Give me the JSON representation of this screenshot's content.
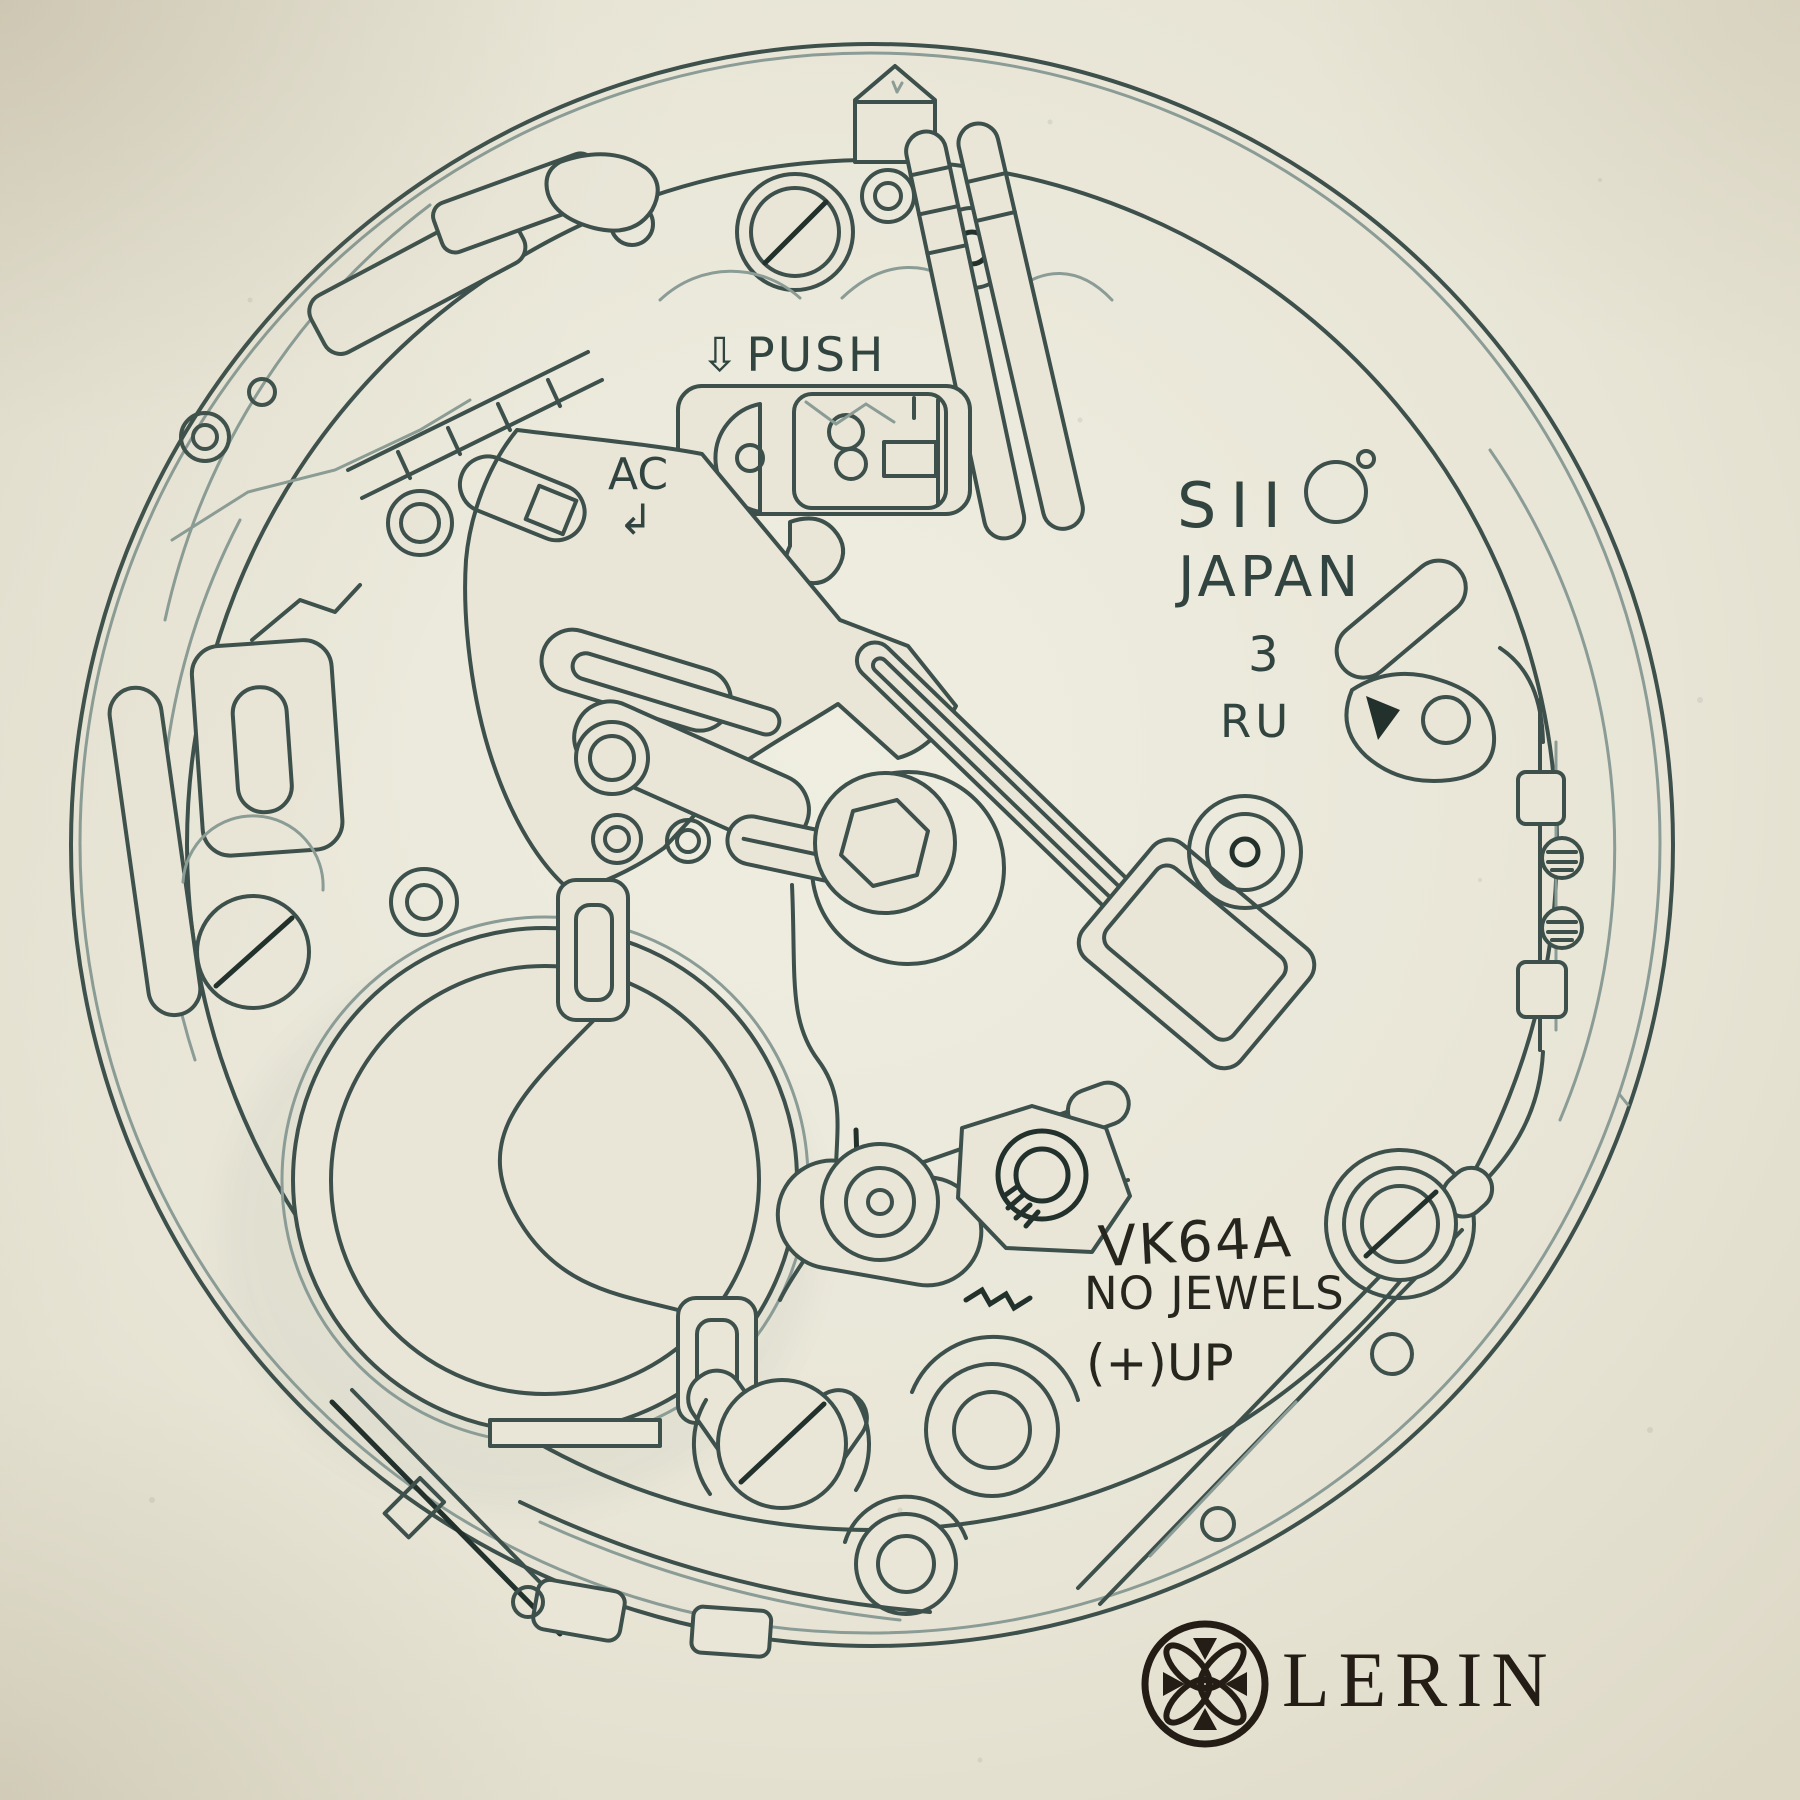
{
  "labels": {
    "push_arrow": "⇩",
    "push": "PUSH",
    "ac": "AC",
    "ac_arrow": "↲",
    "brand": "SII",
    "country": "JAPAN",
    "date_position": "3",
    "code_ru": "RU",
    "caliber": "VK64A",
    "jewel_count": "NO JEWELS",
    "battery_orientation": "(+)UP"
  },
  "signature": {
    "brand": "LERIN"
  },
  "colors": {
    "paper": "#e9e6d8",
    "ink": "#3d504b",
    "ink_light": "#8a9c95",
    "ink_dark": "#22312c",
    "label_dark": "#26261e",
    "logo_ink": "#241d15"
  }
}
